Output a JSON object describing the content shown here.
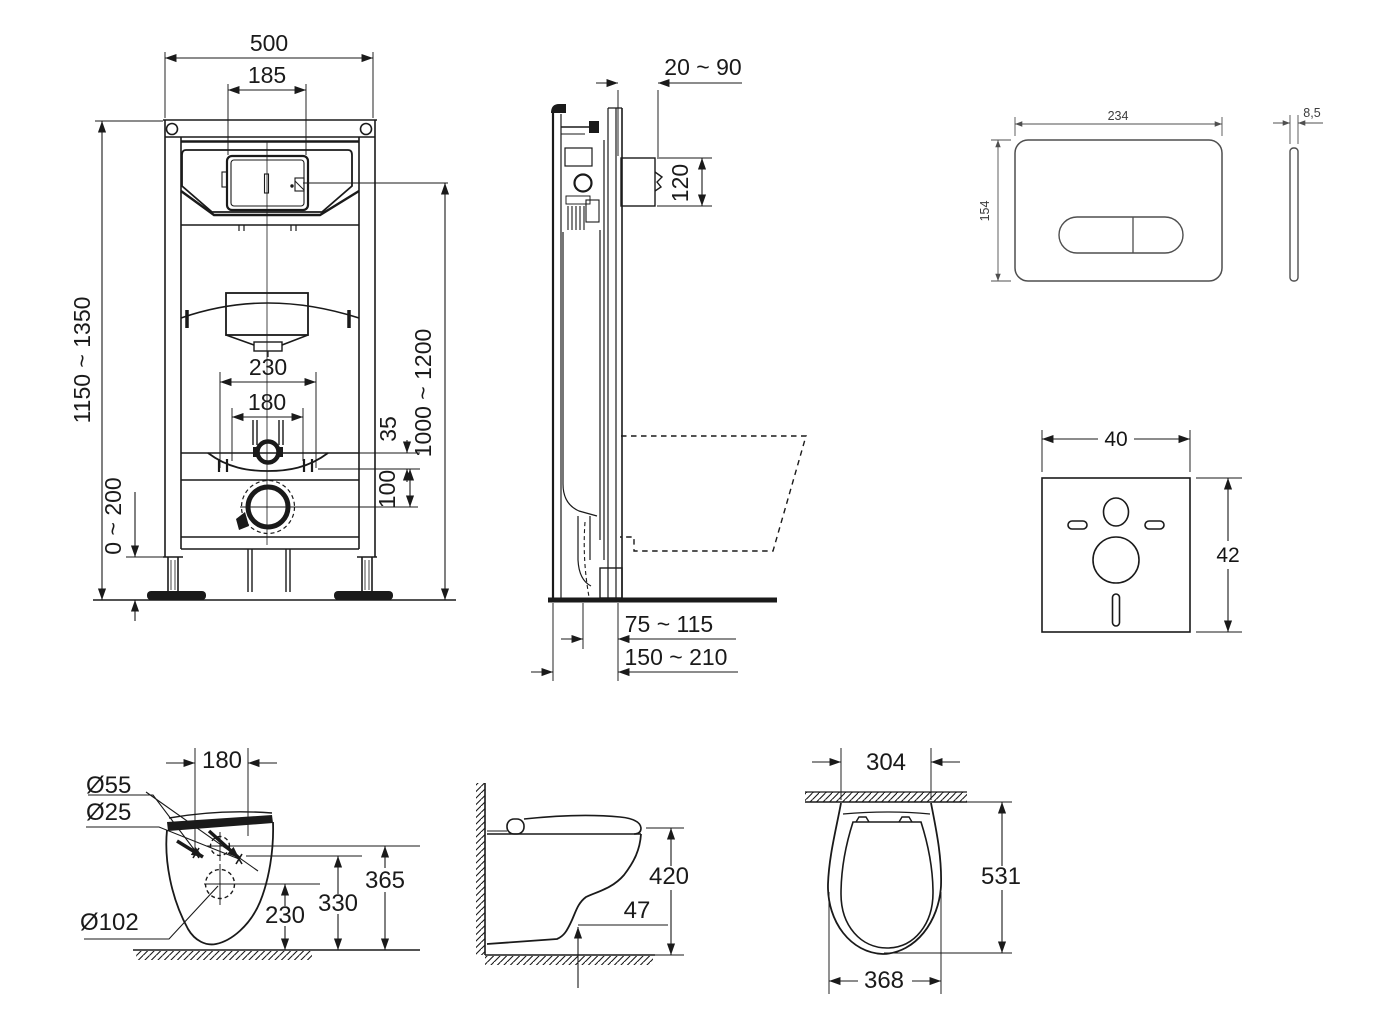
{
  "colors": {
    "ink": "#1a1a1a",
    "plate_ink": "#4f4f4f",
    "background": "#ffffff"
  },
  "frame_front": {
    "width": "500",
    "window_width": "185",
    "height_range": "1150 ~ 1350",
    "leg_adjust_range": "0 ~ 200",
    "bracket_spacing": "230",
    "bolt_spacing": "180",
    "offset_top": "35",
    "offset_drain": "100",
    "outlet_height_range": "1000 ~ 1200"
  },
  "frame_side": {
    "wall_distance_range": "20 ~ 90",
    "flush_pipe_cutout": "120",
    "depth_front_range": "75 ~ 115",
    "depth_total_range": "150 ~ 210"
  },
  "flush_plate": {
    "width": "234",
    "height": "154",
    "thickness": "8,5"
  },
  "sound_pad": {
    "width": "40",
    "height": "42"
  },
  "toilet_rear": {
    "bolt_spacing": "180",
    "drill_seat": "Ø55",
    "drill_bolt": "Ø25",
    "drill_outlet": "Ø102",
    "height_top": "365",
    "height_mid": "330",
    "height_outlet": "230"
  },
  "toilet_side": {
    "height": "420",
    "clearance": "47"
  },
  "toilet_top": {
    "wall_width": "304",
    "depth": "531",
    "width": "368"
  }
}
